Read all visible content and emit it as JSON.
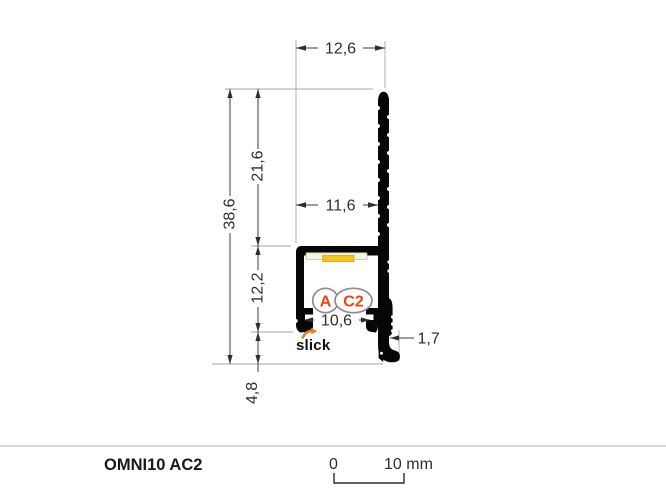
{
  "drawing": {
    "dims": {
      "top_width": "12,6",
      "total_height": "38,6",
      "upper_height": "21,6",
      "mid_width": "11,6",
      "channel_height": "12,2",
      "opening_width": "10,6",
      "foot_thickness": "1,7",
      "foot_height": "4,8"
    },
    "badge_a": "A",
    "badge_c2": "C2",
    "brand": "slick"
  },
  "footer": {
    "product_name": "OMNI10 AC2",
    "scale_zero": "0",
    "scale_ten": "10 mm"
  },
  "colors": {
    "accent_red": "#e8480e",
    "brand_orange": "#ed7a1c",
    "led_yellow": "#f4c41a",
    "led_base": "#f7f3e1",
    "profile_black": "#060606"
  }
}
